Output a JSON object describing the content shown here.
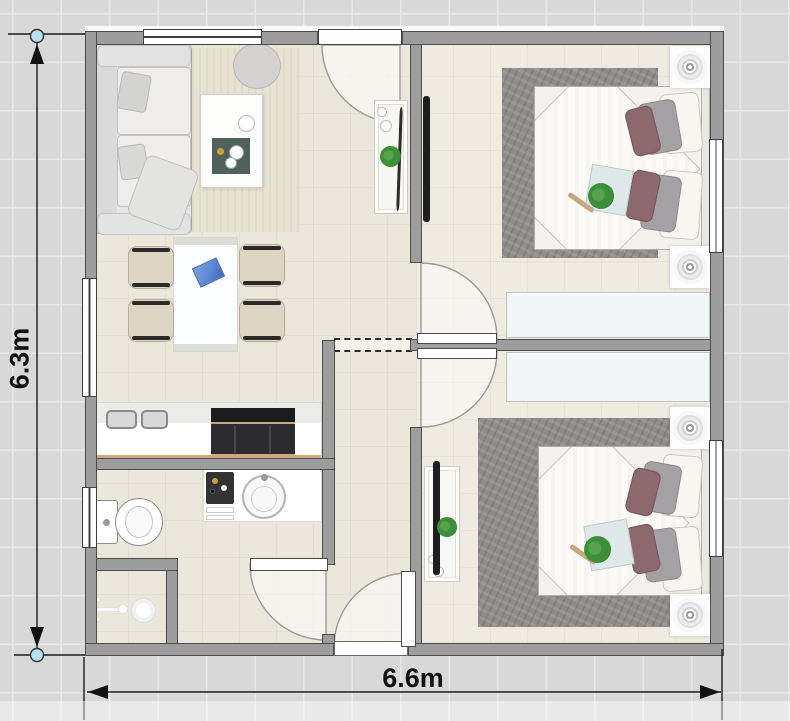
{
  "canvas": {
    "width": 790,
    "height": 721,
    "description": "2D floor plan of a 6.6m x 6.3m two-bedroom house on a gray grid canvas"
  },
  "dimensions": {
    "vertical": {
      "label": "6.3m"
    },
    "horizontal": {
      "label": "6.6m"
    }
  },
  "rooms": [
    "living-room",
    "dining-area",
    "kitchen",
    "hallway",
    "bathroom",
    "shower-stall",
    "bedroom-top",
    "bedroom-bottom"
  ],
  "furniture": [
    "sofa",
    "round-side-table",
    "coffee-table",
    "entry-console",
    "dining-table",
    "dining-chair-x4",
    "kitchen-counter",
    "kitchen-sink",
    "cooktop-oven",
    "bathroom-vanity",
    "vanity-sink",
    "toiletries-tray",
    "toilet",
    "shower-head",
    "wall-tv-bedroom-top",
    "tv-stand-bedroom-bottom",
    "double-bed-x2",
    "bed-tray-with-plant-x2",
    "wardrobe-x2",
    "ceiling-light-x4",
    "gray-area-rug-x2",
    "living-room-rug"
  ],
  "doors": [
    "front-door",
    "bedroom-top-door",
    "bedroom-bottom-door",
    "bathroom-door",
    "back-door"
  ],
  "windows": [
    "living-room-top-window",
    "dining-left-window",
    "bathroom-left-window",
    "bedroom-top-right-window",
    "bedroom-bottom-right-window"
  ],
  "colors": {
    "grid_bg": "#d8d8d8",
    "grid_line": "#e7e7e7",
    "wall_fill": "#9d9d9d",
    "wall_edge": "#4d4d4d",
    "floor_main": "#ece7db",
    "floor_bedroom": "#f0ebe1",
    "rug_gray": "#8f8d8b",
    "rug_living": "#e8e2d3",
    "bed_base": "#f3f2ee",
    "duvet": "#fbfaf7",
    "pillow_white": "#f7f6f3",
    "pillow_gray": "#a3a1a3",
    "pillow_mauve": "#8d686c",
    "wardrobe": "#f2f5f6",
    "tray_blue": "#e0e9ea",
    "plant_green": "#3e8f3a",
    "wood": "#c8a77e",
    "chair_seat": "#ded6c4",
    "chair_arm": "#2a2a2a",
    "placemat_blue": "#5d87d3",
    "appliance_dark": "#232528",
    "tv_dark": "#1f1f21",
    "window_frame": "#3f3f3f",
    "dim_line": "#1b1b1b",
    "handle_fill": "#b5e1f2",
    "handle_edge": "#333333",
    "swing_fill": "rgba(255,255,255,0.5)",
    "swing_edge": "#9b9b9b"
  }
}
